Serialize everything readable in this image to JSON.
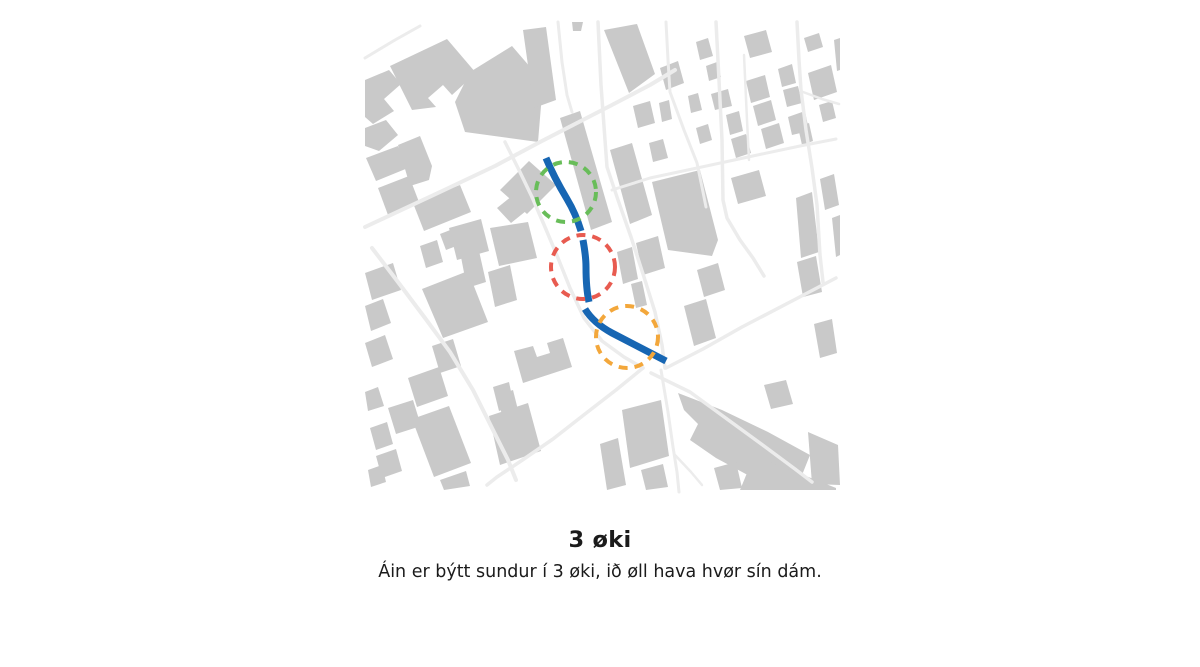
{
  "figure": {
    "title": "3 øki",
    "caption": "Áin er býtt sundur í 3 øki, ið øll hava hvør sín dám."
  },
  "map": {
    "background_color": "#ffffff",
    "building_color": "#c9c9c9",
    "road_color": "#ececec",
    "river": {
      "color": "#1766b3",
      "width": 7,
      "segments": [
        "M 546 158 C 553 175, 561 189, 567 199 C 573 209, 578 221, 581 231",
        "M 583 240 C 585 251, 586 259, 586 267 C 586 281, 587 293, 589 302",
        "M 585 309 C 591 319, 601 327, 612 333 C 629 342, 649 352, 666 361"
      ]
    },
    "zones": [
      {
        "id": "zone-1-upper",
        "color": "#68bd59",
        "cx": 566,
        "cy": 192,
        "r": 30
      },
      {
        "id": "zone-2-middle",
        "color": "#e85b50",
        "cx": 583,
        "cy": 267,
        "r": 32
      },
      {
        "id": "zone-3-lower",
        "color": "#f3a73b",
        "cx": 627,
        "cy": 337,
        "r": 31
      }
    ],
    "roads": [
      {
        "points": "365,227 440,192 495,166 540,142 575,124 610,106 650,85 675,70",
        "width": 4
      },
      {
        "points": "365,58 395,40 420,26",
        "width": 3
      },
      {
        "points": "558,22 562,62 567,95 572,112",
        "width": 3
      },
      {
        "points": "598,22 601,85 605,140 607,167 618,200 631,237 644,277 655,312 662,345 665,368",
        "width": 3.5
      },
      {
        "points": "505,142 519,170 532,197 545,227 558,258 570,288 584,318 602,341 624,357 643,368",
        "width": 3.5
      },
      {
        "points": "666,22 668,60 670,92 684,130 697,163 703,192 706,207",
        "width": 3
      },
      {
        "points": "716,22 719,80 722,140 723,200 727,218 740,240 753,258 764,276",
        "width": 3.5
      },
      {
        "points": "744,55 747,120 749,160",
        "width": 2.5
      },
      {
        "points": "797,22 799,60 801,90 806,130 812,168 817,205 820,255 823,282",
        "width": 3.5
      },
      {
        "points": "612,190 650,178 697,168 725,162 762,154 800,146 836,139",
        "width": 3
      },
      {
        "points": "803,92 822,99 839,104",
        "width": 2.5
      },
      {
        "points": "372,248 398,282 425,318 450,352 473,390 493,430 508,460 516,480",
        "width": 4
      },
      {
        "points": "643,368 616,390 585,414 553,439 521,461 497,477 487,485",
        "width": 3.5
      },
      {
        "points": "661,370 668,412 673,447 677,472 679,492",
        "width": 3
      },
      {
        "points": "675,455 691,472 702,485",
        "width": 2.5
      },
      {
        "points": "666,368 703,349 742,327 792,301 836,278",
        "width": 3.5
      },
      {
        "points": "651,373 690,392 727,419 764,446 795,469 812,482",
        "width": 3.5
      }
    ],
    "buildings": [
      "390,66 447,39 476,73 452,95 443,85 428,98 436,107 412,110",
      "470,72 512,46 543,82 538,142 465,132 455,102",
      "365,80 389,70 401,84 384,99 394,111 373,124 365,117",
      "365,128 386,120 398,135 379,151 365,146",
      "366,158 398,146 408,168 376,181",
      "378,188 409,176 419,202 388,215",
      "398,145 420,136 432,166 429,180 410,186",
      "413,203 460,185 471,212 424,231",
      "440,234 458,227 464,243 446,250",
      "500,190 529,161 556,185 527,214",
      "497,208 522,188 536,203 511,223",
      "523,30 546,27 556,100 534,108",
      "572,22 583,22 581,31 573,31",
      "560,118 580,111 612,222 591,230",
      "610,150 632,143 652,215 630,224",
      "652,182 700,170 718,240 712,256 668,250",
      "636,243 658,236 665,268 643,275",
      "617,252 632,247 638,279 623,284",
      "631,284 642,281 647,305 636,308",
      "490,228 528,222 537,258 499,266",
      "449,228 481,219 489,251 457,260",
      "420,246 437,240 443,262 426,268",
      "461,257 479,251 486,282 467,288",
      "604,30 637,24 655,74 629,93",
      "660,68 678,61 684,83 666,90",
      "696,42 708,38 713,56 700,60",
      "706,66 717,62 721,77 709,81",
      "633,106 650,101 655,123 638,128",
      "659,103 669,100 672,119 662,122",
      "688,96 698,93 702,110 691,113",
      "711,94 728,89 732,106 715,110",
      "696,128 708,124 712,140 700,144",
      "726,115 739,111 743,131 730,135",
      "649,143 663,139 668,158 653,162",
      "731,139 746,134 751,153 736,158",
      "746,81 765,75 770,97 751,103",
      "753,106 771,100 776,120 758,126",
      "761,129 779,123 784,143 766,149",
      "778,69 792,64 796,83 782,87",
      "783,90 798,86 802,103 787,107",
      "788,117 805,111 809,131 792,135",
      "804,38 819,33 823,47 808,52",
      "808,73 831,65 837,92 814,100",
      "819,105 832,101 836,118 823,122",
      "798,127 809,123 813,141 802,145",
      "834,40 840,38 840,70 837,71",
      "820,179 834,174 839,205 825,210",
      "832,218 840,215 840,255 836,257",
      "796,198 812,192 819,252 801,258",
      "731,178 759,170 766,196 738,204",
      "744,36 766,30 772,52 750,58",
      "697,270 718,263 725,290 704,297",
      "684,306 706,299 716,338 694,346",
      "797,262 816,256 822,292 803,297",
      "814,324 832,319 837,353 820,358",
      "365,273 393,263 401,290 372,300",
      "365,306 383,299 391,323 371,331",
      "365,343 385,335 393,359 372,367",
      "365,392 378,387 384,406 368,411",
      "422,289 468,271 488,322 443,338",
      "488,272 510,265 517,300 495,307",
      "432,346 453,339 461,366 440,373",
      "408,378 439,367 448,396 417,407",
      "388,408 413,400 421,426 396,434",
      "370,428 387,422 393,444 376,450",
      "412,419 449,406 471,463 434,477",
      "376,456 396,449 402,471 382,478",
      "489,416 528,403 541,451 500,465",
      "497,395 513,390 519,414 503,419",
      "440,480 466,471 470,486 444,490",
      "368,470 382,465 386,482 371,487",
      "514,351 533,346 537,357 550,353 547,343 563,338 572,367 523,383",
      "493,387 509,382 514,406 499,411",
      "622,410 661,400 669,456 630,468",
      "641,470 663,464 668,487 646,490",
      "678,393 722,410 768,432 810,455 800,480 757,480 716,458 690,440 698,424 684,410",
      "754,456 796,472 836,488 836,490 740,490",
      "714,468 736,462 742,488 720,490",
      "600,444 618,438 626,485 607,490",
      "764,385 786,380 793,404 771,409",
      "808,432 838,445 840,485 812,484"
    ]
  }
}
